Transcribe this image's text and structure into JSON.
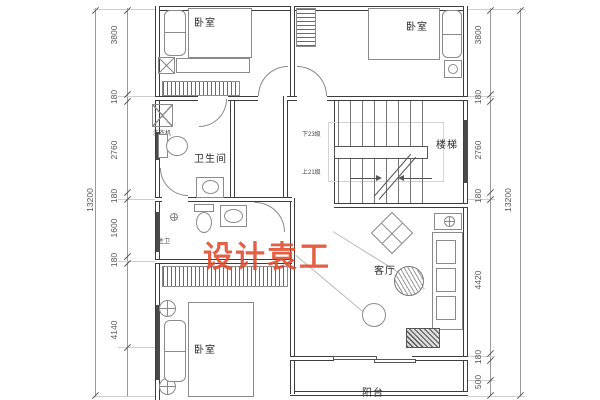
{
  "watermark": {
    "text": "设计袁工",
    "color": "#e2492c"
  },
  "labels": {
    "bedroom_top_left": "卧室",
    "bedroom_top_right": "卧室",
    "bathroom": "卫生间",
    "washing_machine": "洗衣机",
    "stairs": "楼梯",
    "stairs_down": "下23级",
    "stairs_up": "上21级",
    "bathroom_small": "主卫",
    "living_room": "客厅",
    "bedroom_bottom": "卧室",
    "balcony": "阳台"
  },
  "dimensions": {
    "left_total": "13200",
    "right_total": "13200",
    "left": [
      "3800",
      "180",
      "2760",
      "180",
      "1600",
      "180",
      "4140"
    ],
    "right": [
      "3800",
      "180",
      "2760",
      "180",
      "4420",
      "180",
      "500"
    ]
  }
}
